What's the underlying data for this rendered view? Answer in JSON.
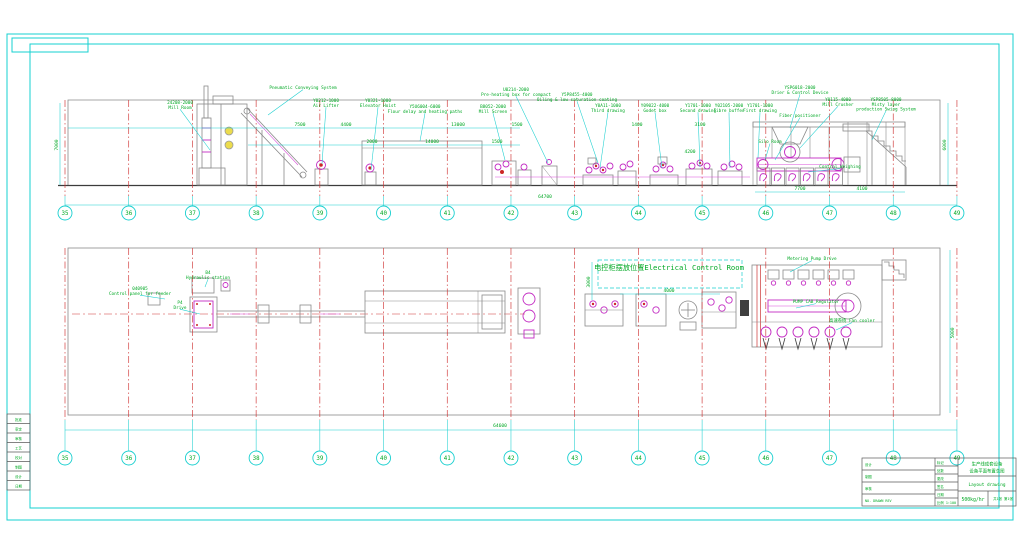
{
  "frame_note": "",
  "grid": {
    "numbers": [
      35,
      36,
      37,
      38,
      39,
      40,
      41,
      42,
      43,
      44,
      45,
      46,
      47,
      48,
      49
    ],
    "x0": 65,
    "step": 63.71,
    "rows": [
      {
        "line": [
          100,
          196
        ],
        "bubble_y": 213
      },
      {
        "line": [
          248,
          420
        ],
        "bubble_y": 458
      }
    ]
  },
  "labels_top": [
    {
      "t": [
        "24208-2000",
        "Mill Room"
      ],
      "x": 180,
      "y": 100,
      "lx": 210,
      "ly": 150
    },
    {
      "t": [
        "Pneumatic Conveying System"
      ],
      "x": 303,
      "y": 85,
      "lx": 268,
      "ly": 115
    },
    {
      "t": [
        "Y0212-1000",
        "Air Lifter"
      ],
      "x": 326,
      "y": 98,
      "lx": 322,
      "ly": 164
    },
    {
      "t": [
        "Y0321-1000",
        "Elevator Hoist"
      ],
      "x": 378,
      "y": 98,
      "lx": 371,
      "ly": 170
    },
    {
      "t": [
        "Y5U6004-6000",
        "Flour delay and heating paths"
      ],
      "x": 425,
      "y": 104,
      "lx": 420,
      "ly": 141
    },
    {
      "t": [
        "U0214-2000",
        "Pre-heating box for compact"
      ],
      "x": 516,
      "y": 87,
      "lx": 548,
      "ly": 163
    },
    {
      "t": [
        "B8052-2000",
        "Mill Screen"
      ],
      "x": 493,
      "y": 104,
      "lx": 505,
      "ly": 160
    },
    {
      "t": [
        "Y5P8455-4000",
        "Oiling & low saturation coating"
      ],
      "x": 577,
      "y": 92,
      "lx": 598,
      "ly": 163
    },
    {
      "t": [
        "Y0A11-1000",
        "Third drawing"
      ],
      "x": 608,
      "y": 103,
      "lx": 600,
      "ly": 168
    },
    {
      "t": [
        "Y09022-4000",
        "Godet box"
      ],
      "x": 655,
      "y": 103,
      "lx": 662,
      "ly": 168
    },
    {
      "t": [
        "Y1701-1000",
        "Second drawing"
      ],
      "x": 698,
      "y": 103,
      "lx": 700,
      "ly": 167
    },
    {
      "t": [
        "Y02105-2000",
        "Fibre buffer"
      ],
      "x": 729,
      "y": 103,
      "lx": 730,
      "ly": 168
    },
    {
      "t": [
        "Y1701-1000",
        "First drawing"
      ],
      "x": 760,
      "y": 103,
      "lx": 758,
      "ly": 158
    },
    {
      "t": [
        "YSP6018-2000",
        "Drier & Control Device"
      ],
      "x": 800,
      "y": 85,
      "lx": 790,
      "ly": 128
    },
    {
      "t": [
        "Y0115-4000",
        "Mill Crusher"
      ],
      "x": 838,
      "y": 97,
      "lx": 800,
      "ly": 148
    },
    {
      "t": [
        "YSP8505-8000",
        "Misty layer",
        "production Swing System"
      ],
      "x": 886,
      "y": 97,
      "lx": 872,
      "ly": 140
    },
    {
      "t": [
        "Fiber positioner"
      ],
      "x": 800,
      "y": 113,
      "lx": 775,
      "ly": 160
    },
    {
      "t": [
        "Silo Room"
      ],
      "x": 770,
      "y": 139,
      "lx": 765,
      "ly": 160
    },
    {
      "t": [
        "Contral Weighing"
      ],
      "x": 840,
      "y": 164,
      "lx": 808,
      "ly": 172
    }
  ],
  "labels_bottom": [
    {
      "t": [
        "B4",
        "Hydraulic station"
      ],
      "x": 208,
      "y": 270,
      "lx": 205,
      "ly": 287
    },
    {
      "t": [
        "040905",
        "Control panel for feeder"
      ],
      "x": 140,
      "y": 286,
      "lx": 165,
      "ly": 299
    },
    {
      "t": [
        "P4",
        "Drive"
      ],
      "x": 180,
      "y": 300,
      "lx": 200,
      "ly": 314
    },
    {
      "t": [
        "电控柜摆放位置Electrical Control Room"
      ],
      "x": 669,
      "y": 266,
      "big": true
    },
    {
      "t": [
        "Metering Pump Drive"
      ],
      "x": 812,
      "y": 256,
      "lx": 790,
      "ly": 272
    },
    {
      "t": [
        "PUMP CAB Regulator"
      ],
      "x": 816,
      "y": 299,
      "lx": 796,
      "ly": 308
    },
    {
      "t": [
        "高速卷绕 Fan cooler"
      ],
      "x": 852,
      "y": 318,
      "lx": 836,
      "ly": 330
    }
  ],
  "dims": [
    {
      "t": "7000",
      "x": 58,
      "y": 145,
      "r": -90
    },
    {
      "t": "7500",
      "x": 300,
      "y": 126
    },
    {
      "t": "4400",
      "x": 346,
      "y": 126
    },
    {
      "t": "13000",
      "x": 458,
      "y": 126
    },
    {
      "t": "1500",
      "x": 517,
      "y": 126
    },
    {
      "t": "1400",
      "x": 637,
      "y": 126
    },
    {
      "t": "3100",
      "x": 700,
      "y": 126
    },
    {
      "t": "2000",
      "x": 372,
      "y": 143
    },
    {
      "t": "14000",
      "x": 432,
      "y": 143
    },
    {
      "t": "1500",
      "x": 497,
      "y": 143
    },
    {
      "t": "4200",
      "x": 690,
      "y": 153
    },
    {
      "t": "7700",
      "x": 800,
      "y": 190
    },
    {
      "t": "4100",
      "x": 862,
      "y": 190
    },
    {
      "t": "64700",
      "x": 545,
      "y": 198
    },
    {
      "t": "6000",
      "x": 946,
      "y": 145,
      "r": -90
    },
    {
      "t": "4000",
      "x": 669,
      "y": 292
    },
    {
      "t": "3000",
      "x": 590,
      "y": 282,
      "r": -90
    },
    {
      "t": "64600",
      "x": 500,
      "y": 427
    },
    {
      "t": "5000",
      "x": 954,
      "y": 333,
      "r": -90
    }
  ],
  "dim_lines": [
    [
      68,
      128,
      520,
      128
    ],
    [
      248,
      145,
      520,
      145
    ],
    [
      65,
      205,
      957,
      205
    ],
    [
      65,
      430,
      957,
      430
    ],
    [
      755,
      192,
      905,
      192
    ],
    [
      620,
      294,
      720,
      294
    ],
    [
      60,
      103,
      60,
      185
    ],
    [
      948,
      103,
      948,
      185
    ],
    [
      950,
      250,
      950,
      413
    ],
    [
      592,
      262,
      592,
      300
    ]
  ],
  "title_block": {
    "x": 862,
    "y": 458,
    "w": 154,
    "h": 48,
    "sign_rows": [
      "设计",
      "制图",
      "审核",
      "NO. DRAWN REV"
    ],
    "mid_rows": [
      "标记",
      "处数",
      "更改",
      "签名",
      "日期",
      "比例 1:100"
    ],
    "company_lines": [
      "生产线成套设备",
      "设备平面布置总图"
    ],
    "drawing_name": "Layout drawing",
    "capacity": "500kg/hr",
    "sheet_note": "共1张 第1张"
  },
  "revision_strip": {
    "x": 7,
    "y": 414,
    "w": 23,
    "h": 76,
    "rows": [
      "批准",
      "审定",
      "审核",
      "工艺",
      "校对",
      "制图",
      "设计",
      "日期"
    ]
  }
}
